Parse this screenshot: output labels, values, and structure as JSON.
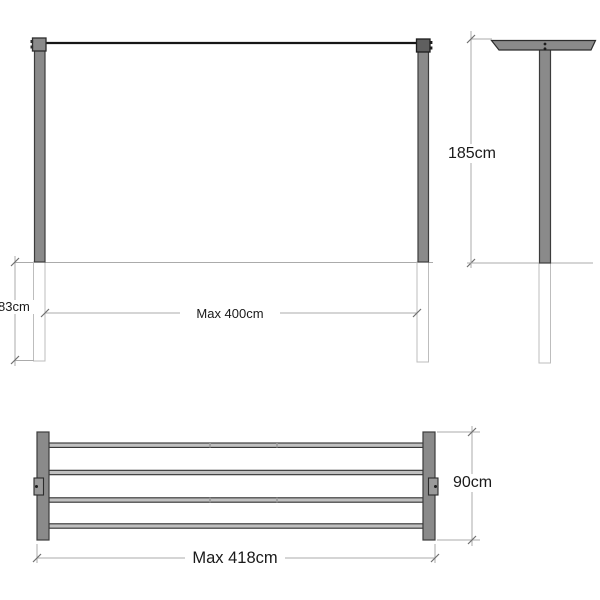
{
  "drawing": {
    "front_view": {
      "height": "185cm",
      "underground_depth": "83cm",
      "span": "Max 400cm"
    },
    "plan_view": {
      "overall_width": "Max 418cm",
      "depth": "90cm"
    },
    "colors": {
      "post_fill": "#8a8a8a",
      "post_outline": "#3c3c3c",
      "cap_dark_fill": "#5f5f5f",
      "cable": "#161616",
      "rail_fill": "#c0c0c0",
      "dimension_line": "#ababab",
      "underground_outline": "#bdbdbd",
      "text": "#1a1a1a",
      "background": "#ffffff"
    }
  }
}
